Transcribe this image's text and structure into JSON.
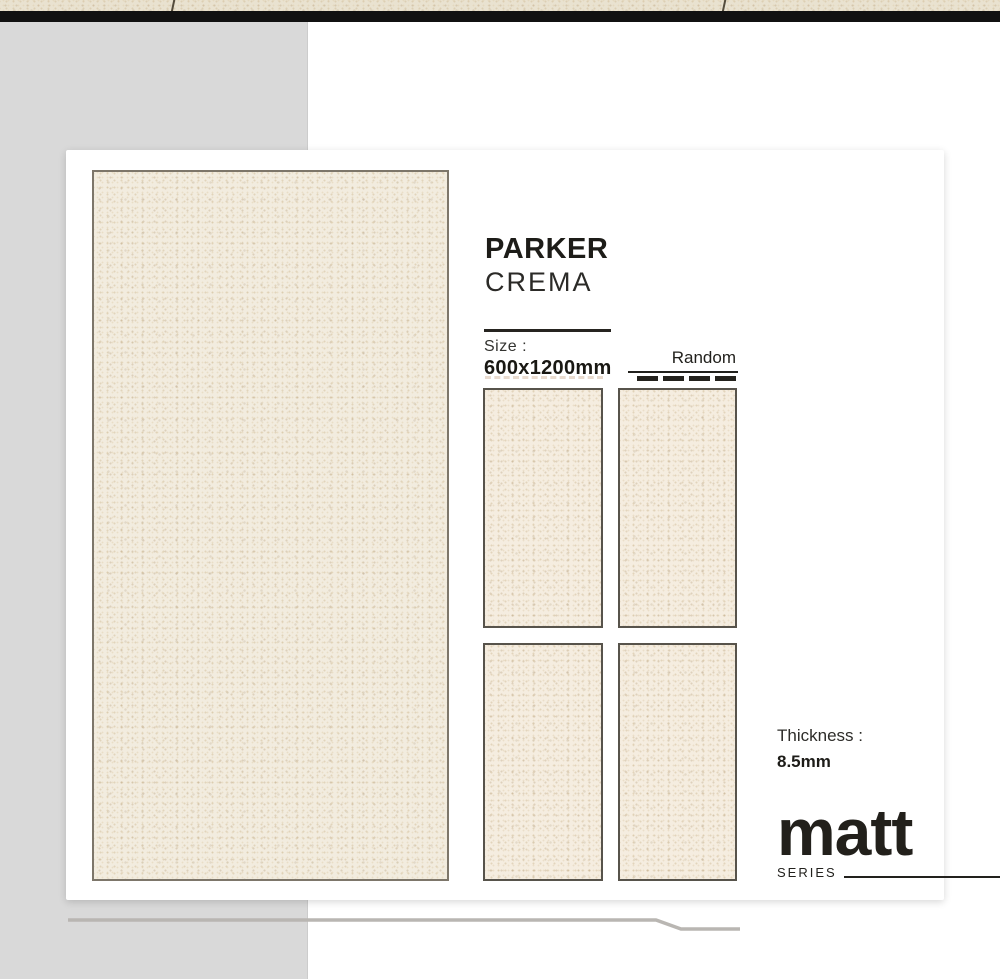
{
  "product": {
    "name": "PARKER",
    "variant": "CREMA",
    "size_label": "Size :",
    "size_value": "600x1200mm",
    "layout_label": "Random",
    "thickness_label": "Thickness :",
    "thickness_value": "8.5mm"
  },
  "series": {
    "name": "matt",
    "label": "SERIES"
  },
  "swatches": {
    "main_swatch": "full tile face",
    "random_face_count": 4,
    "random_dash_count": 4
  },
  "colors": {
    "tile_cream": "#f2ecdf",
    "tile_cream_small": "#f5ede0",
    "tile_border_dark": "#57534b",
    "tile_border_light": "#7d766a",
    "card_background": "#ffffff",
    "left_panel_gray": "#d9d9d9",
    "top_bar_black": "#111111",
    "photo_strip_beige": "#e9e2d0",
    "text_dark": "#1d1c18",
    "bottom_accent_line": "#b9b6b2"
  }
}
